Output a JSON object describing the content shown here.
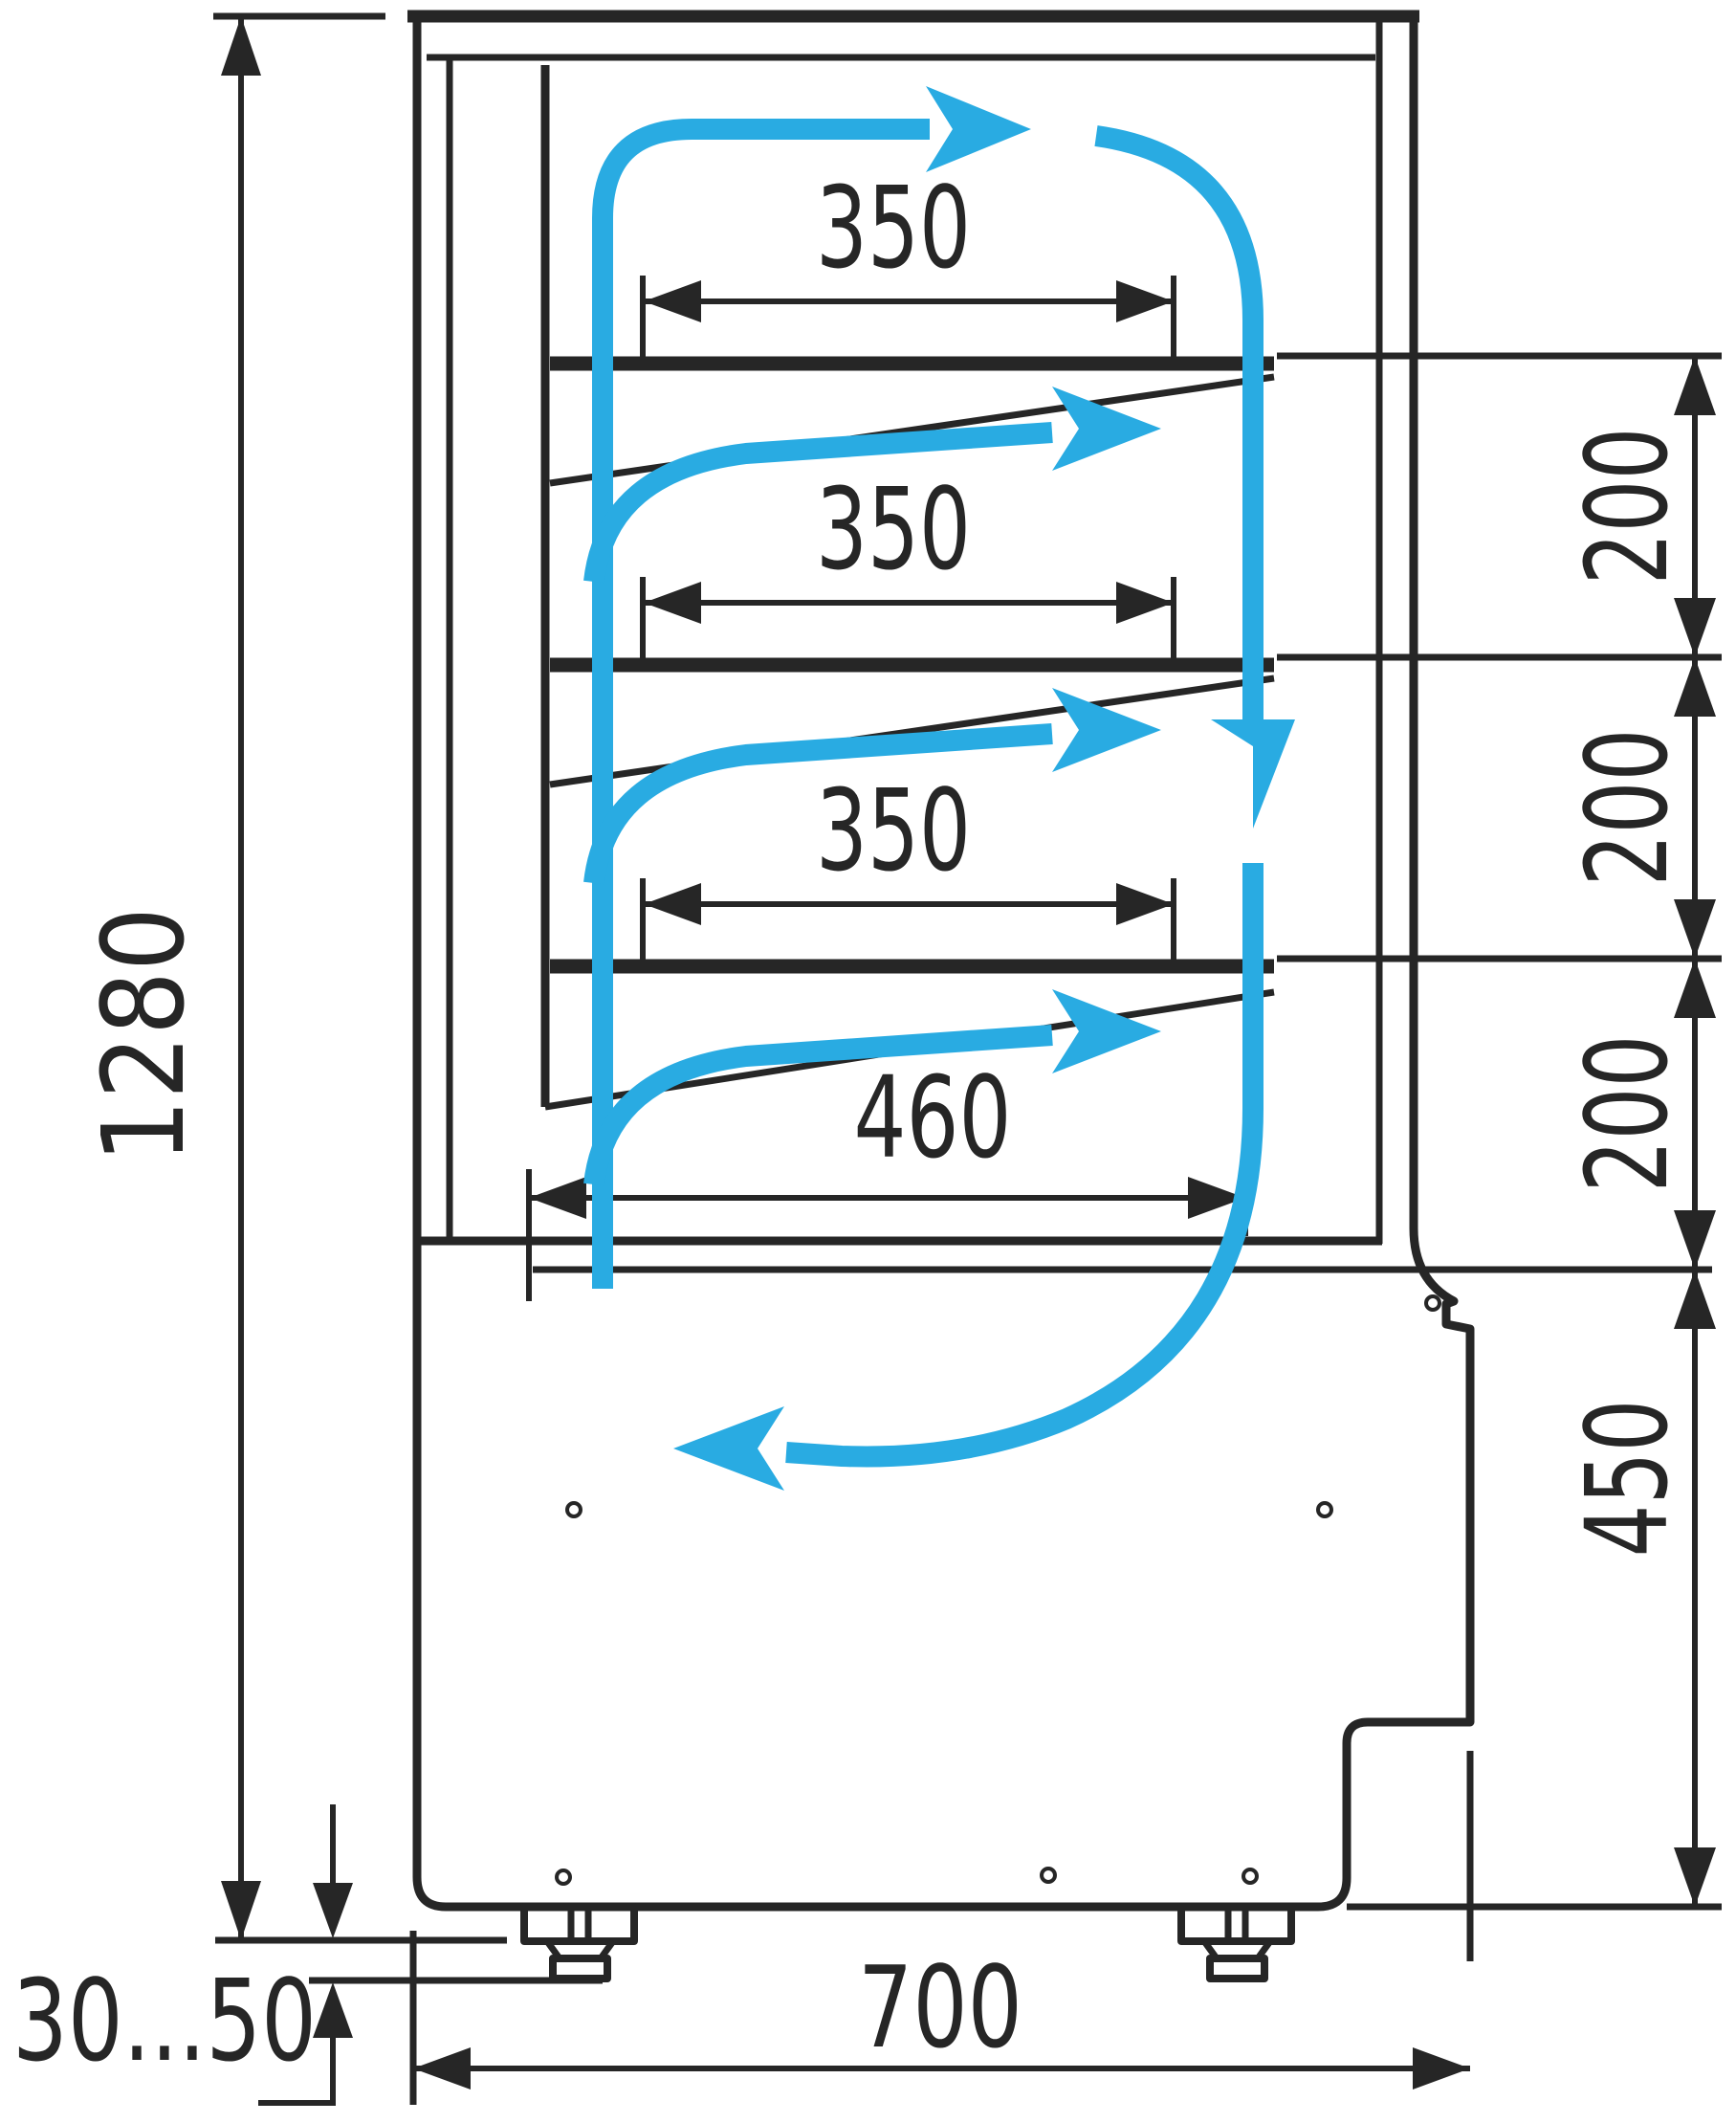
{
  "drawing": {
    "kind": "technical-dimension-drawing",
    "subject": "refrigerated pastry display case side cross-section with air circulation",
    "colors": {
      "line": "#262626",
      "airflow": "#29ABE2",
      "background": "#FFFFFF"
    },
    "dims": {
      "overall_height": "1280",
      "shelf_depths": [
        "350",
        "350",
        "350"
      ],
      "deck_depth": "460",
      "shelf_gaps": [
        "200",
        "200",
        "200"
      ],
      "base_height": "450",
      "depth": "700",
      "feet_range": "30...50"
    },
    "airflow": {
      "description": "closed air loop: up rear duct, across top, down front glass, return at base, outlets above each shelf",
      "arrowheads": 6
    }
  }
}
